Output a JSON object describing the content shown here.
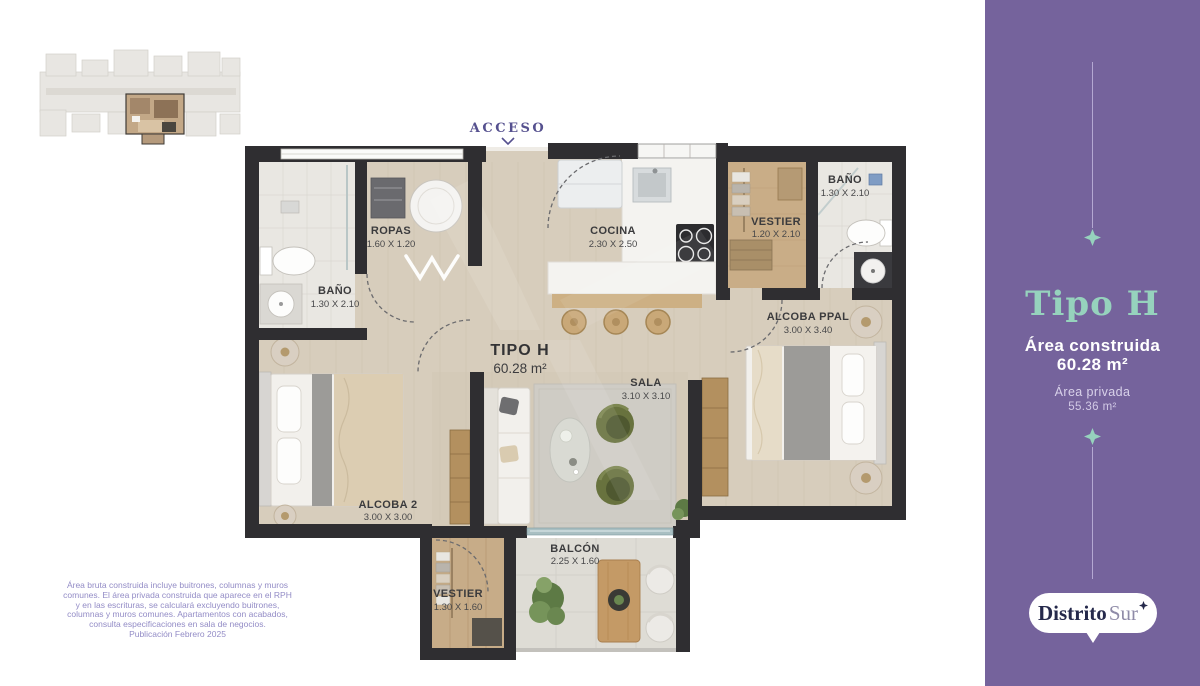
{
  "plan": {
    "access_label": "ACCESO",
    "unit": {
      "name": "TIPO H",
      "area": "60.28 m²"
    },
    "rooms": {
      "bano_left": {
        "name": "BAÑO",
        "dims": "1.30 X 2.10"
      },
      "ropas": {
        "name": "ROPAS",
        "dims": "1.60 X 1.20"
      },
      "cocina": {
        "name": "COCINA",
        "dims": "2.30 X 2.50"
      },
      "vestier_ppal": {
        "name": "VESTIER",
        "dims": "1.20 X 2.10"
      },
      "bano_ppal": {
        "name": "BAÑO",
        "dims": "1.30 X 2.10"
      },
      "alcoba_ppal": {
        "name": "ALCOBA PPAL",
        "dims": "3.00 X 3.40"
      },
      "sala": {
        "name": "SALA",
        "dims": "3.10 X 3.10"
      },
      "alcoba_2": {
        "name": "ALCOBA 2",
        "dims": "3.00 X 3.00"
      },
      "balcon": {
        "name": "BALCÓN",
        "dims": "2.25 X 1.60"
      },
      "vestier_2": {
        "name": "VESTIER",
        "dims": "1.30 X 1.60"
      }
    }
  },
  "panel": {
    "type_label": "Tipo H",
    "built_area_label": "Área construida",
    "built_area_value": "60.28 m²",
    "private_area_label": "Área privada",
    "private_area_value": "55.36 m²",
    "brand_primary": "Distrito",
    "brand_secondary": "Sur",
    "colors": {
      "panel_background": "#75639c",
      "accent_teal": "#96d2bd",
      "logo_navy": "#25294b",
      "wall_dark": "#2f2e31",
      "floor_wood": "#d7cdbc",
      "acceso_purple": "#56518f"
    }
  },
  "disclaimer": {
    "lines": [
      "Área bruta construida incluye buitrones, columnas y muros",
      "comunes. El área privada construida que aparece en el RPH",
      "y en las escrituras, se calculará excluyendo buitrones,",
      "columnas y muros comunes. Apartamentos con acabados,",
      "consulta especificaciones en sala de negocios.",
      "Publicación Febrero 2025"
    ]
  }
}
